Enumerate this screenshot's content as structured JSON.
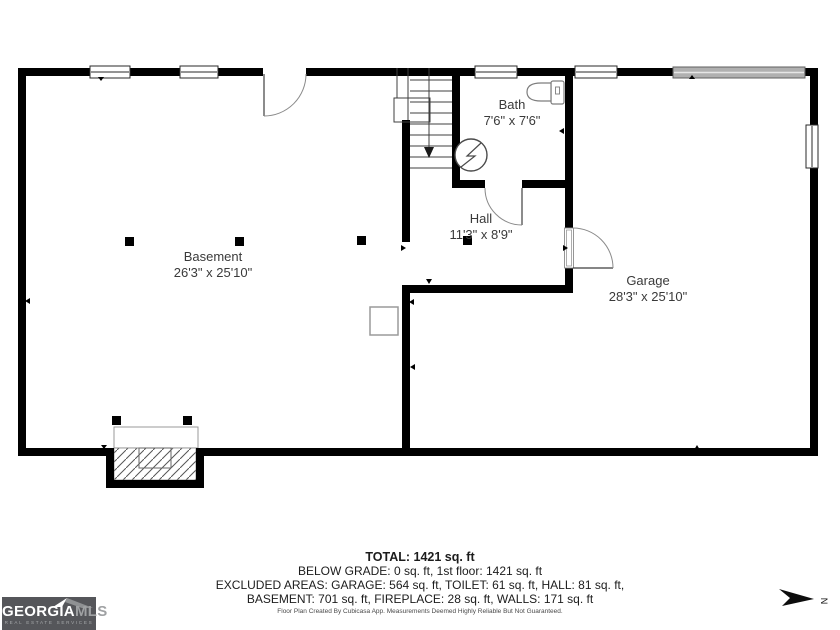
{
  "floorplan": {
    "rooms": [
      {
        "name": "Basement",
        "dims": "26'3\" x 25'10\""
      },
      {
        "name": "Bath",
        "dims": "7'6\" x 7'6\""
      },
      {
        "name": "Hall",
        "dims": "11'3\" x 8'9\""
      },
      {
        "name": "Garage",
        "dims": "28'3\" x 25'10\""
      }
    ],
    "fixtures": [
      "toilet",
      "water-heater",
      "stairs",
      "fireplace"
    ]
  },
  "summary": {
    "total": "TOTAL: 1421 sq. ft",
    "below_grade": "BELOW GRADE: 0 sq. ft, 1st floor: 1421 sq. ft",
    "excluded_1": "EXCLUDED AREAS: GARAGE: 564 sq. ft, TOILET: 61 sq. ft, HALL: 81 sq. ft,",
    "excluded_2": "BASEMENT: 701 sq. ft, FIREPLACE: 28 sq. ft, WALLS: 171 sq. ft"
  },
  "disclaimer": "Floor Plan Created By Cubicasa App. Measurements Deemed Highly Reliable But Not Guaranteed.",
  "logo": {
    "brand": "GEORGIA",
    "brand_suffix": "MLS",
    "tagline": "REAL ESTATE SERVICES"
  },
  "compass": {
    "north_label": "N"
  },
  "colors": {
    "wall": "#000000",
    "garage_door": "#b0b0b0",
    "logo_bg": "#55565a",
    "label_text": "#3a3a3a"
  }
}
